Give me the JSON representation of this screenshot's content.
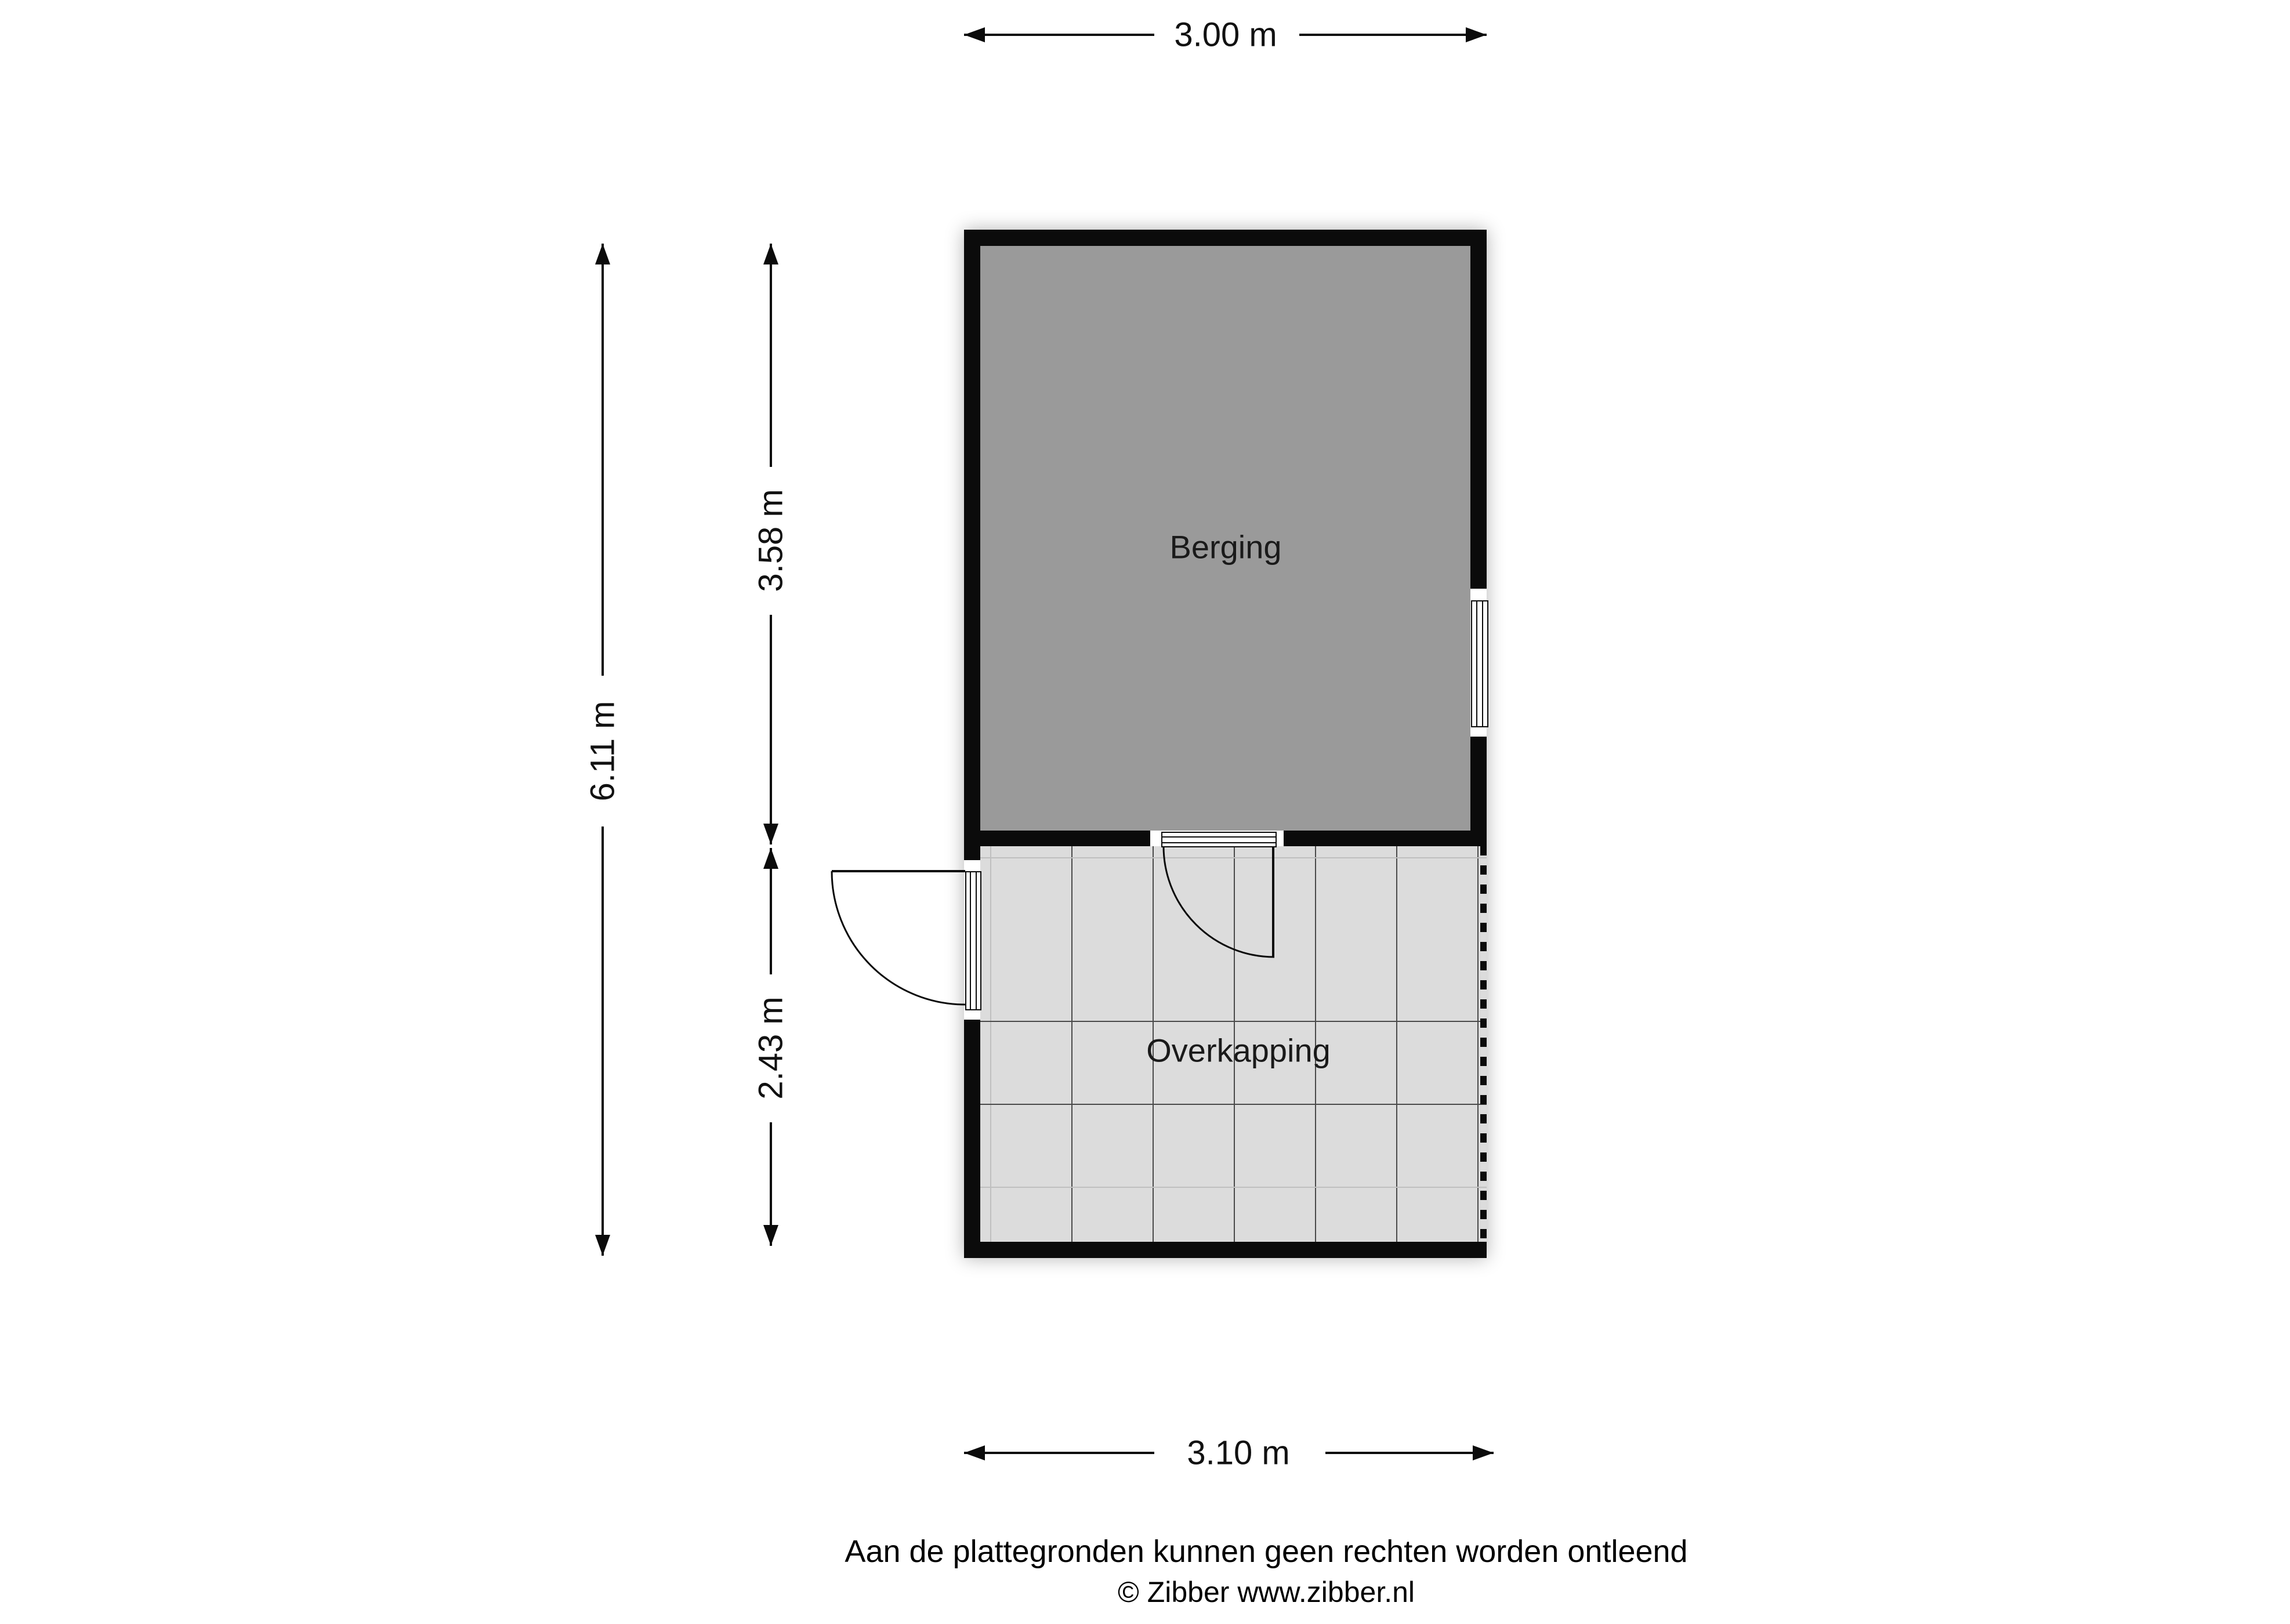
{
  "rooms": {
    "berging": "Berging",
    "overkapping": "Overkapping"
  },
  "dimensions": {
    "top_width": "3.00 m",
    "bottom_width": "3.10 m",
    "total_height": "6.11 m",
    "berging_height": "3.58 m",
    "overkapping_height": "2.43 m"
  },
  "footer": {
    "disclaimer": "Aan de plattegronden kunnen geen rechten worden ontleend",
    "copyright": "© Zibber www.zibber.nl"
  },
  "colors": {
    "wall": "#0b0b0b",
    "berging_fill": "#9a9a9a",
    "overkapping_fill": "#dcdcdc",
    "grid_dark": "#4a4a4a",
    "grid_light": "#bfbfbf",
    "dim_text": "#111111"
  }
}
